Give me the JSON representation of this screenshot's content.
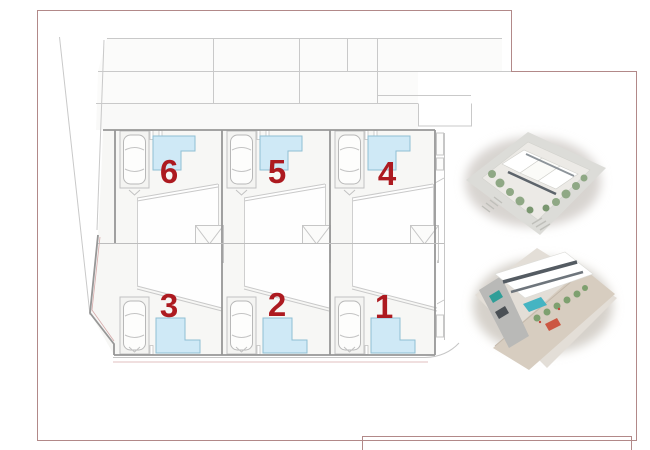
{
  "drawing": {
    "type": "residential-site-plan",
    "plots": [
      {
        "id": "plot-6",
        "label": "6",
        "row": "top",
        "position": "left"
      },
      {
        "id": "plot-5",
        "label": "5",
        "row": "top",
        "position": "center"
      },
      {
        "id": "plot-4",
        "label": "4",
        "row": "top",
        "position": "right"
      },
      {
        "id": "plot-3",
        "label": "3",
        "row": "bottom",
        "position": "left"
      },
      {
        "id": "plot-2",
        "label": "2",
        "row": "bottom",
        "position": "center"
      },
      {
        "id": "plot-1",
        "label": "1",
        "row": "bottom",
        "position": "right"
      }
    ],
    "colors": {
      "plot_number": "#ad1a20",
      "pool_fill": "#cfe9f6",
      "pool_outline": "#8fbfd4",
      "frame": "#b28989",
      "wall_dark": "#979797",
      "line_light": "#c9c9c9"
    }
  },
  "renders": [
    {
      "id": "render-aerial-top",
      "name": "aerial-3d-render-front"
    },
    {
      "id": "render-aerial-bottom",
      "name": "aerial-3d-render-rear"
    }
  ]
}
